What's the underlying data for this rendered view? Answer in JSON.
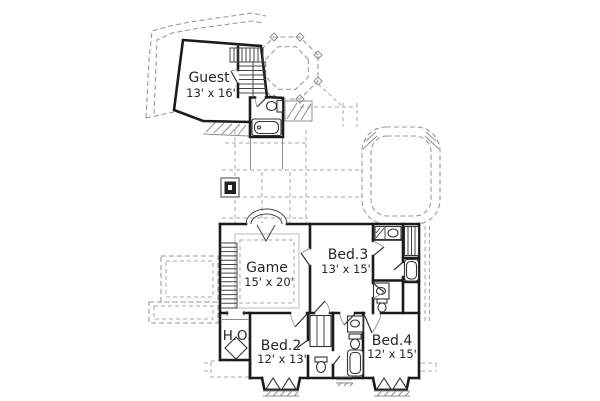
{
  "plan": {
    "title": "second floor plan",
    "rooms": {
      "guest": {
        "name": "Guest",
        "dims": "13' x 16'"
      },
      "game": {
        "name": "Game",
        "dims": "15' x 20'"
      },
      "bed3": {
        "name": "Bed.3",
        "dims": "13' x 15'"
      },
      "bed2": {
        "name": "Bed.2",
        "dims": "12' x 13'"
      },
      "bed4": {
        "name": "Bed.4",
        "dims": "12' x 15'"
      },
      "ho": {
        "name": "H.O."
      }
    },
    "colors": {
      "wall": "#1b1b1b",
      "roof_dash": "#9a9a9a",
      "fixture_line": "#333333",
      "text": "#262626",
      "background": "#ffffff"
    }
  }
}
